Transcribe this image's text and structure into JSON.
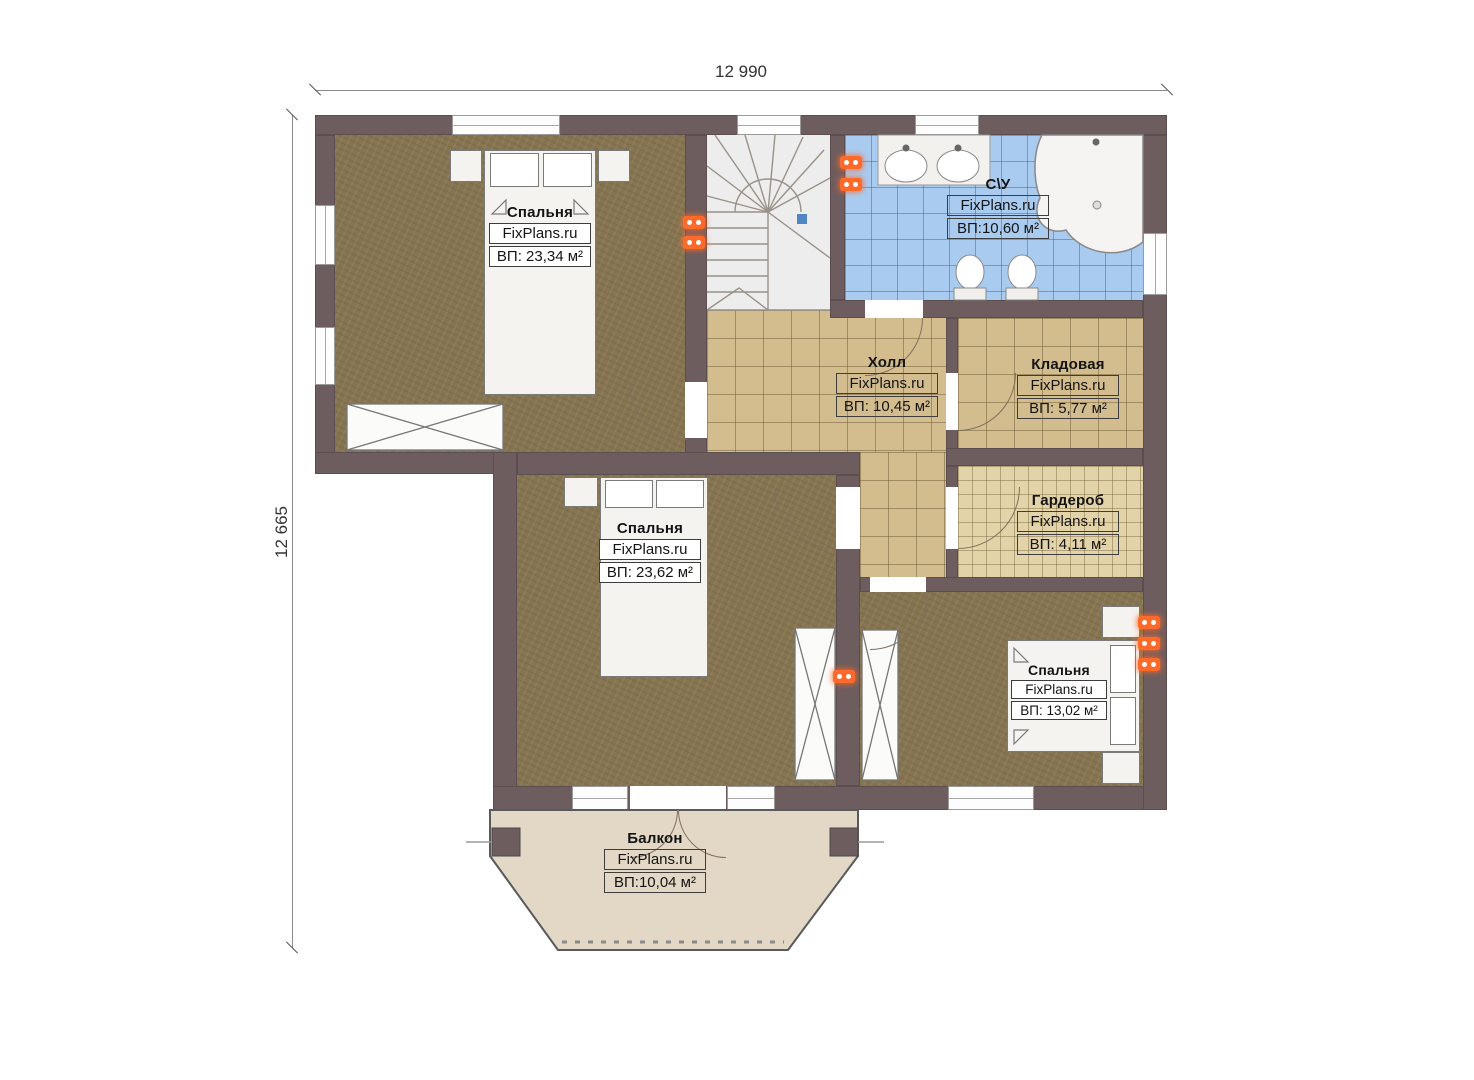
{
  "plan": {
    "watermark": "FixPlans.ru",
    "dim_width": "12 990",
    "dim_height": "12 665",
    "rooms": {
      "bedroom1": {
        "name": "Спальня",
        "area": "ВП: 23,34 м²"
      },
      "bathroom": {
        "name": "С\\У",
        "area": "ВП:10,60 м²"
      },
      "hall": {
        "name": "Холл",
        "area": "ВП: 10,45 м²"
      },
      "storage": {
        "name": "Кладовая",
        "area": "ВП: 5,77 м²"
      },
      "wardrobe": {
        "name": "Гардероб",
        "area": "ВП: 4,11 м²"
      },
      "bedroom2": {
        "name": "Спальня",
        "area": "ВП: 23,62 м²"
      },
      "bedroom3": {
        "name": "Спальня",
        "area": "ВП: 13,02 м²"
      },
      "balcony": {
        "name": "Балкон",
        "area": "ВП:10,04 м²"
      }
    },
    "colors": {
      "wall": "#6e5d5e",
      "bedroom_floor": "#877551",
      "tile_floor": "#d3bd8f",
      "fine_tile_floor": "#e3d3a9",
      "bath_floor": "#a9cbef",
      "balcony_floor": "#e2d8c5",
      "stairs_floor": "#ededed",
      "socket": "#ff6a2a"
    }
  }
}
